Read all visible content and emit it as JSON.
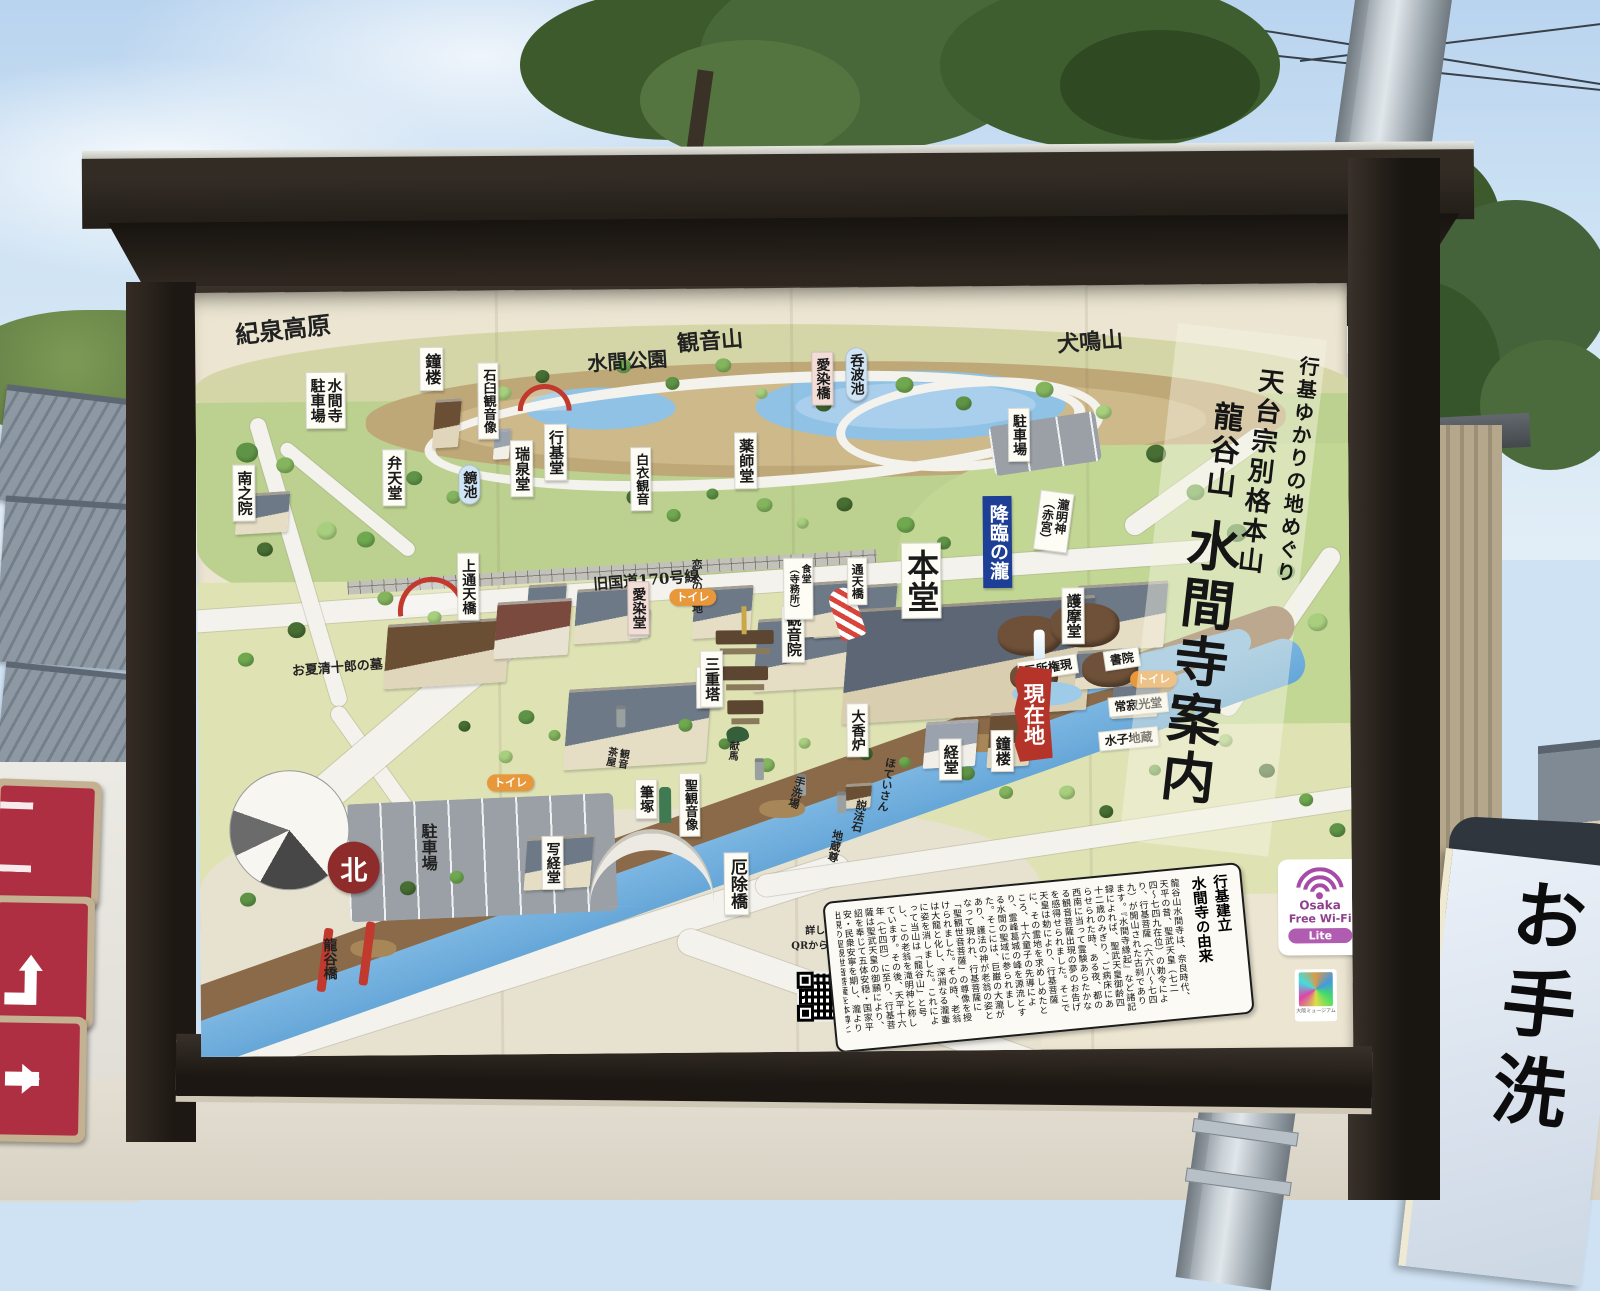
{
  "scene": {
    "restroom_sign_text": "お手洗"
  },
  "board": {
    "title_columns": [
      "行基ゆかりの地めぐり",
      "天台宗別格本山",
      "龍谷山",
      "水間寺案内"
    ]
  },
  "map": {
    "compass_label": "北",
    "current_location": "現在地",
    "qr": {
      "line1": "詳しくは",
      "line2": "QRからHPへ!"
    },
    "history": {
      "title_right": "行基建立",
      "title_left": "水間寺の由来",
      "body": "龍谷山水間寺は、奈良時代、天平の昔、聖武天皇（七二四〜七四九在位）の勅令により、行基菩薩（六六八〜七四九）が開山された古刹であります。『水間寺縁起』など諸記録によれば、聖武天皇御齢四十二歳のみぎり、ご病床にあらせられた時、ある夜、都の西南に当って霊験あらたかなる観音菩薩出現の夢のお告げを感得せられました。そこで天皇は勅により、行基菩薩に、その霊地を求めしめたところ、十六童子の先導により、霊峰葛城の峰を源流とする水間の聖域に参られました。そこには、巨巌の大瀧があり、護法の神が老翁の姿となって現われ、行基菩薩に「聖観世音菩薩」の尊像を授けられました。その時、老翁は大龍と化し、深淵なる瀧壷に姿を消しました。これによって当山は「龍谷山」と号し、この老翁を滝明神と称しています。その後、天平十六年（七四四）に至り、行基菩薩は聖武天皇の御願により、詔を奉じて五体安穏・国家平安・民衆安寧を期し、瀧より出現の聖観世音菩薩を本尊として水間寺を創建されました。"
    },
    "wifi": {
      "t1": "Osaka",
      "t2": "Free Wi-Fi",
      "badge": "Lite",
      "museum": "大阪ミュージアム"
    },
    "labels": [
      {
        "st": "mt",
        "t": "紀泉高原",
        "x": 40,
        "y": 26,
        "fs": 24,
        "r": -6
      },
      {
        "st": "mt",
        "t": "観音山",
        "x": 482,
        "y": 42,
        "fs": 22,
        "r": -4
      },
      {
        "st": "mt",
        "t": "犬鳴山",
        "x": 862,
        "y": 46,
        "fs": 22,
        "r": -4
      },
      {
        "st": "mt",
        "t": "水間公園",
        "x": 392,
        "y": 62,
        "fs": 20,
        "r": -3
      },
      {
        "st": "wv",
        "t": "鐘楼",
        "x": 224,
        "y": 56,
        "fs": 16
      },
      {
        "st": "wv",
        "t": "石臼観音像",
        "x": 282,
        "y": 72,
        "fs": 13
      },
      {
        "st": "w2",
        "lines": [
          "水間寺",
          "駐車場"
        ],
        "x": 110,
        "y": 80,
        "fs": 15
      },
      {
        "st": "wv",
        "t": "南之院",
        "x": 36,
        "y": 172,
        "fs": 15
      },
      {
        "st": "wv",
        "t": "弁天堂",
        "x": 186,
        "y": 158,
        "fs": 15
      },
      {
        "st": "bp",
        "t": "鏡池",
        "x": 262,
        "y": 174,
        "fs": 14
      },
      {
        "st": "wv",
        "t": "瑞泉堂",
        "x": 314,
        "y": 150,
        "fs": 15
      },
      {
        "st": "wv",
        "t": "行基堂",
        "x": 348,
        "y": 134,
        "fs": 15
      },
      {
        "st": "wv",
        "t": "白衣観音",
        "x": 434,
        "y": 158,
        "fs": 13
      },
      {
        "st": "wv",
        "t": "薬師堂",
        "x": 538,
        "y": 144,
        "fs": 15
      },
      {
        "st": "pk",
        "t": "愛染橋",
        "x": 616,
        "y": 64,
        "fs": 14
      },
      {
        "st": "bp",
        "t": "呑波池",
        "x": 650,
        "y": 60,
        "fs": 14
      },
      {
        "st": "wv",
        "t": "駐車場",
        "x": 812,
        "y": 122,
        "fs": 14
      },
      {
        "st": "w2",
        "lines": [
          "瀧明神",
          "（赤宮）"
        ],
        "x": 840,
        "y": 206,
        "fs": 12,
        "r": 8
      },
      {
        "st": "nv",
        "t": "降臨の瀧",
        "x": 786,
        "y": 210,
        "fs": 19
      },
      {
        "st": "ph",
        "t": "旧国道170号線",
        "x": 396,
        "y": 284,
        "fs": 15,
        "r": -4
      },
      {
        "st": "wv",
        "t": "上通天橋",
        "x": 260,
        "y": 262,
        "fs": 14
      },
      {
        "st": "pv",
        "t": "恋人の聖地",
        "x": 494,
        "y": 270,
        "fs": 11
      },
      {
        "st": "pk",
        "t": "愛染堂",
        "x": 430,
        "y": 292,
        "fs": 14
      },
      {
        "st": "wv",
        "t": "観音院",
        "x": 584,
        "y": 318,
        "fs": 15
      },
      {
        "st": "wv",
        "t": "護摩堂",
        "x": 864,
        "y": 302,
        "fs": 15
      },
      {
        "st": "wv",
        "t": "客殿",
        "x": 498,
        "y": 378,
        "fs": 15
      },
      {
        "st": "wv",
        "t": "三重塔",
        "x": 502,
        "y": 362,
        "fs": 15
      },
      {
        "st": "w2",
        "lines": [
          "食堂",
          "（寺務所）"
        ],
        "x": 586,
        "y": 270,
        "fs": 10
      },
      {
        "st": "wv",
        "t": "通天橋",
        "x": 650,
        "y": 270,
        "fs": 12
      },
      {
        "st": "wv",
        "t": "本堂",
        "x": 704,
        "y": 256,
        "fs": 32
      },
      {
        "st": "wv",
        "t": "大香炉",
        "x": 648,
        "y": 416,
        "fs": 14
      },
      {
        "st": "whs",
        "t": "三所権現",
        "x": 820,
        "y": 372,
        "fs": 12,
        "r": -8
      },
      {
        "st": "whs",
        "t": "書院",
        "x": 906,
        "y": 364,
        "fs": 12,
        "r": -8
      },
      {
        "st": "whs",
        "t": "常寂光堂",
        "x": 910,
        "y": 410,
        "fs": 12,
        "r": -5
      },
      {
        "st": "whs",
        "t": "水子地蔵",
        "x": 900,
        "y": 444,
        "fs": 12,
        "r": -5
      },
      {
        "st": "tl",
        "t": "トイレ",
        "x": 472,
        "y": 300,
        "fs": 11
      },
      {
        "st": "tl",
        "t": "トイレ",
        "x": 932,
        "y": 386,
        "fs": 11
      },
      {
        "st": "tl",
        "t": "トイレ",
        "x": 288,
        "y": 484,
        "fs": 11
      },
      {
        "st": "wv",
        "t": "鐘楼",
        "x": 792,
        "y": 444,
        "fs": 15
      },
      {
        "st": "wv",
        "t": "経堂",
        "x": 740,
        "y": 452,
        "fs": 15
      },
      {
        "st": "pv",
        "t": "ほていさん",
        "x": 682,
        "y": 470,
        "fs": 11,
        "r": 10
      },
      {
        "st": "pv",
        "t": "手洗場",
        "x": 592,
        "y": 488,
        "fs": 11,
        "r": 16
      },
      {
        "st": "pv",
        "t": "説法石",
        "x": 654,
        "y": 512,
        "fs": 11,
        "r": 12
      },
      {
        "st": "pv",
        "t": "地蔵尊",
        "x": 630,
        "y": 542,
        "fs": 11,
        "r": 12
      },
      {
        "st": "pv",
        "t": "献馬",
        "x": 528,
        "y": 452,
        "fs": 10,
        "r": 6
      },
      {
        "st": "wv",
        "t": "聖観音像",
        "x": 480,
        "y": 484,
        "fs": 13
      },
      {
        "st": "wv",
        "t": "筆塚",
        "x": 436,
        "y": 490,
        "fs": 14
      },
      {
        "st": "p2",
        "lines": [
          "観音",
          "茶屋"
        ],
        "x": 406,
        "y": 458,
        "fs": 10,
        "r": 10
      },
      {
        "st": "pv",
        "t": "駐車場",
        "x": 220,
        "y": 532,
        "fs": 16
      },
      {
        "st": "wv",
        "t": "写経堂",
        "x": 342,
        "y": 546,
        "fs": 14
      },
      {
        "st": "wv",
        "t": "厄除橋",
        "x": 524,
        "y": 564,
        "fs": 17
      },
      {
        "st": "pv",
        "t": "龍谷橋",
        "x": 122,
        "y": 646,
        "fs": 14
      },
      {
        "st": "ph",
        "t": "お夏清十郎の墓",
        "x": 94,
        "y": 370,
        "fs": 13,
        "r": -4
      }
    ]
  }
}
